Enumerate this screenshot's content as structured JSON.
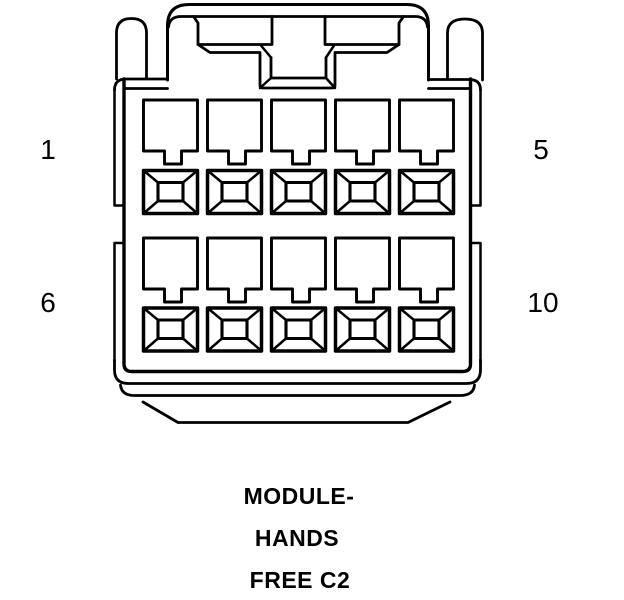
{
  "diagram": {
    "title": "Connector face view",
    "caption": {
      "line1": "MODULE-",
      "line2": "HANDS",
      "line3": "FREE C2"
    },
    "pin_labels": {
      "row1_first": "1",
      "row1_last": "5",
      "row2_first": "6",
      "row2_last": "10"
    },
    "pin_count": 10,
    "rows": 2,
    "columns": 5,
    "line_color": "#000000",
    "background_color": "#ffffff"
  }
}
